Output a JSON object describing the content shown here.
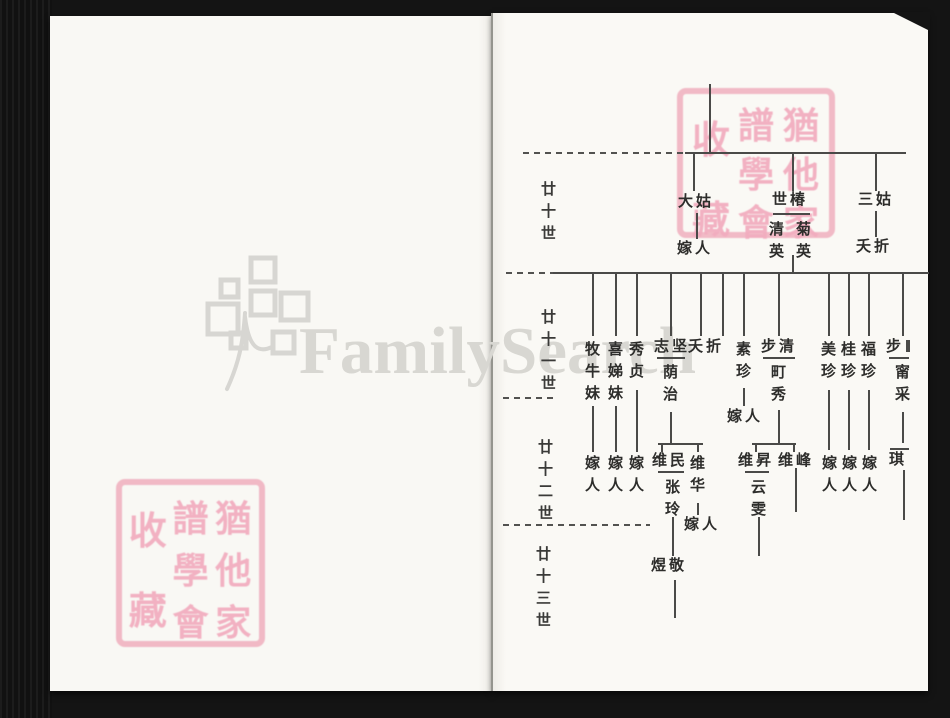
{
  "watermark": {
    "brand": "FamilySearch"
  },
  "seal": {
    "columns": [
      "猶他家",
      "譜學會",
      "收藏"
    ]
  },
  "chart": {
    "gen_labels": [
      {
        "text": "廿十世",
        "x": 540,
        "y": 179
      },
      {
        "text": "廿十一世",
        "x": 540,
        "y": 307
      },
      {
        "text": "廿十二世",
        "x": 537,
        "y": 437
      },
      {
        "text": "廿十三世",
        "x": 535,
        "y": 544
      }
    ],
    "dashes": [
      [
        523,
        683,
        152
      ],
      [
        506,
        553,
        272
      ],
      [
        503,
        556,
        397
      ],
      [
        503,
        650,
        524
      ]
    ],
    "hlines": [
      [
        685,
        906,
        152
      ],
      [
        553,
        929,
        272
      ],
      [
        773,
        810,
        213
      ],
      [
        657,
        685,
        357
      ],
      [
        763,
        795,
        357
      ],
      [
        889,
        909,
        357
      ],
      [
        658,
        703,
        443
      ],
      [
        752,
        796,
        443
      ],
      [
        658,
        684,
        471
      ],
      [
        745,
        769,
        471
      ],
      [
        890,
        909,
        448
      ]
    ],
    "vlines": [
      [
        709,
        84,
        152
      ],
      [
        693,
        152,
        191
      ],
      [
        792,
        152,
        191
      ],
      [
        875,
        152,
        191
      ],
      [
        696,
        213,
        239
      ],
      [
        792,
        255,
        272
      ],
      [
        875,
        211,
        237
      ],
      [
        592,
        272,
        336
      ],
      [
        615,
        272,
        336
      ],
      [
        636,
        272,
        336
      ],
      [
        670,
        272,
        336
      ],
      [
        700,
        272,
        336
      ],
      [
        722,
        272,
        336
      ],
      [
        743,
        272,
        336
      ],
      [
        778,
        272,
        336
      ],
      [
        828,
        272,
        336
      ],
      [
        848,
        272,
        336
      ],
      [
        868,
        272,
        336
      ],
      [
        902,
        272,
        336
      ],
      [
        592,
        406,
        452
      ],
      [
        615,
        406,
        452
      ],
      [
        636,
        390,
        452
      ],
      [
        670,
        412,
        443
      ],
      [
        743,
        388,
        406
      ],
      [
        778,
        410,
        443
      ],
      [
        828,
        390,
        450
      ],
      [
        848,
        390,
        450
      ],
      [
        868,
        390,
        450
      ],
      [
        902,
        412,
        443
      ],
      [
        661,
        443,
        452
      ],
      [
        697,
        443,
        452
      ],
      [
        755,
        443,
        452
      ],
      [
        793,
        443,
        452
      ],
      [
        672,
        517,
        556
      ],
      [
        697,
        503,
        515
      ],
      [
        758,
        517,
        556
      ],
      [
        795,
        468,
        512
      ],
      [
        903,
        470,
        520
      ],
      [
        674,
        580,
        618
      ],
      [
        906,
        340,
        352,
        4
      ]
    ],
    "texts": [
      {
        "t": "大姑",
        "x": 678,
        "y": 194,
        "o": "h"
      },
      {
        "t": "嫁人",
        "x": 677,
        "y": 241,
        "o": "h"
      },
      {
        "t": "世椿",
        "x": 772,
        "y": 192,
        "o": "h"
      },
      {
        "t": "清英",
        "x": 768,
        "y": 219,
        "o": "v"
      },
      {
        "t": "菊英",
        "x": 795,
        "y": 219,
        "o": "v"
      },
      {
        "t": "三姑",
        "x": 858,
        "y": 192,
        "o": "h"
      },
      {
        "t": "夭折",
        "x": 856,
        "y": 239,
        "o": "h"
      },
      {
        "t": "牧牛妹",
        "x": 584,
        "y": 339,
        "o": "v"
      },
      {
        "t": "喜娣妹",
        "x": 607,
        "y": 339,
        "o": "v"
      },
      {
        "t": "秀贞",
        "x": 628,
        "y": 339,
        "o": "v"
      },
      {
        "t": "志坚",
        "x": 654,
        "y": 339,
        "o": "h"
      },
      {
        "t": "荫治",
        "x": 662,
        "y": 362,
        "o": "v"
      },
      {
        "t": "夭折",
        "x": 688,
        "y": 339,
        "o": "h"
      },
      {
        "t": "素珍",
        "x": 735,
        "y": 339,
        "o": "v"
      },
      {
        "t": "嫁人",
        "x": 727,
        "y": 409,
        "o": "h"
      },
      {
        "t": "步清",
        "x": 761,
        "y": 339,
        "o": "h"
      },
      {
        "t": "町秀",
        "x": 770,
        "y": 362,
        "o": "v"
      },
      {
        "t": "美珍",
        "x": 820,
        "y": 339,
        "o": "v"
      },
      {
        "t": "桂珍",
        "x": 840,
        "y": 339,
        "o": "v"
      },
      {
        "t": "福珍",
        "x": 860,
        "y": 339,
        "o": "v"
      },
      {
        "t": "步",
        "x": 886,
        "y": 339,
        "o": "h"
      },
      {
        "t": "甯采",
        "x": 894,
        "y": 362,
        "o": "v"
      },
      {
        "t": "嫁人",
        "x": 584,
        "y": 453,
        "o": "v"
      },
      {
        "t": "嫁人",
        "x": 607,
        "y": 453,
        "o": "v"
      },
      {
        "t": "嫁人",
        "x": 628,
        "y": 453,
        "o": "v"
      },
      {
        "t": "维民",
        "x": 652,
        "y": 453,
        "o": "h"
      },
      {
        "t": "张玲",
        "x": 664,
        "y": 477,
        "o": "v"
      },
      {
        "t": "维华",
        "x": 689,
        "y": 453,
        "o": "v"
      },
      {
        "t": "嫁人",
        "x": 684,
        "y": 517,
        "o": "h"
      },
      {
        "t": "维昇",
        "x": 738,
        "y": 453,
        "o": "h"
      },
      {
        "t": "云雯",
        "x": 750,
        "y": 477,
        "o": "v"
      },
      {
        "t": "维峰",
        "x": 778,
        "y": 453,
        "o": "h"
      },
      {
        "t": "嫁人",
        "x": 821,
        "y": 453,
        "o": "v"
      },
      {
        "t": "嫁人",
        "x": 841,
        "y": 453,
        "o": "v"
      },
      {
        "t": "嫁人",
        "x": 861,
        "y": 453,
        "o": "v"
      },
      {
        "t": "琪",
        "x": 889,
        "y": 452,
        "o": "h"
      },
      {
        "t": "煜敬",
        "x": 651,
        "y": 558,
        "o": "h"
      }
    ]
  }
}
